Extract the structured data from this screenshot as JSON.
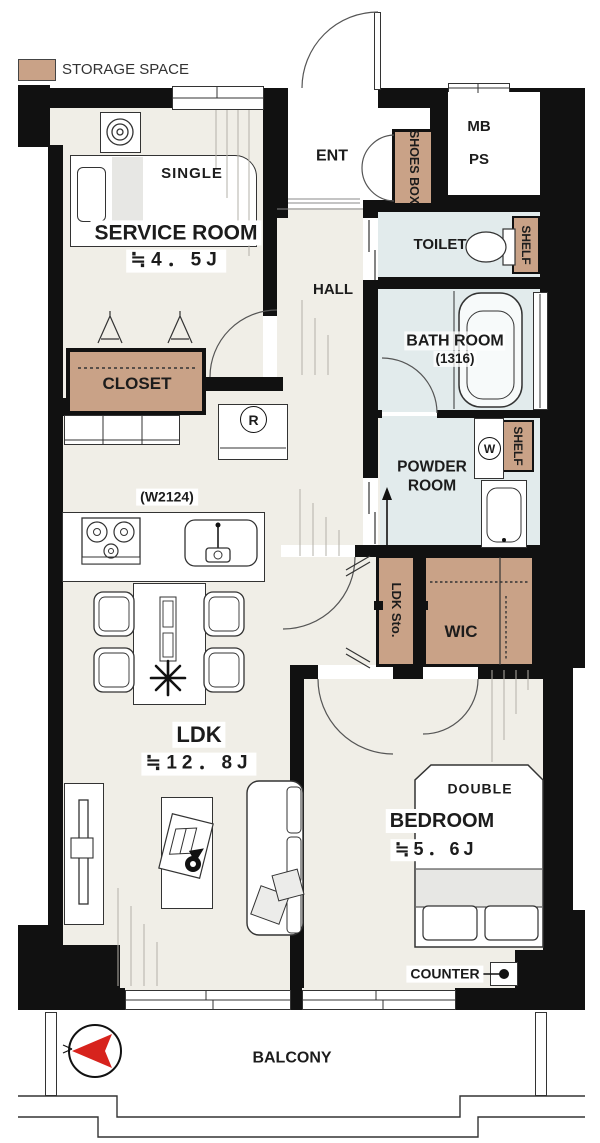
{
  "legend": {
    "storage_label": "STORAGE SPACE"
  },
  "rooms": {
    "service_room": {
      "name": "SERVICE ROOM",
      "size": "≒4．5J"
    },
    "entrance": {
      "label": "ENT"
    },
    "hall": {
      "label": "HALL"
    },
    "toilet": {
      "label": "TOILET"
    },
    "bathroom": {
      "name": "BATH ROOM",
      "size": "(1316)"
    },
    "powder_room": {
      "label": "POWDER ROOM"
    },
    "ldk": {
      "name": "LDK",
      "size": "≒12．8J"
    },
    "bedroom": {
      "name": "BEDROOM",
      "size": "≒5．6J"
    },
    "wic": {
      "label": "WIC"
    },
    "ldk_storage": {
      "label": "LDK Sto."
    },
    "closet": {
      "label": "CLOSET"
    },
    "balcony": {
      "label": "BALCONY"
    }
  },
  "storage": {
    "shoes_box": "SHOES BOX",
    "toilet_shelf": "SHELF",
    "powder_shelf": "SHELF"
  },
  "utility": {
    "meter_box": "MB",
    "pipe_space": "PS",
    "washing_machine": "W",
    "refrigerator": "R"
  },
  "furniture": {
    "single_bed": "SINGLE",
    "double_bed": "DOUBLE",
    "counter": "COUNTER"
  },
  "kitchen": {
    "width_label": "(W2124)"
  },
  "colors": {
    "wall": "#111111",
    "wood_floor": "#f0eee7",
    "wet_floor": "#e2ebec",
    "storage_fill": "#c9a287",
    "compass_red": "#d7231d"
  }
}
